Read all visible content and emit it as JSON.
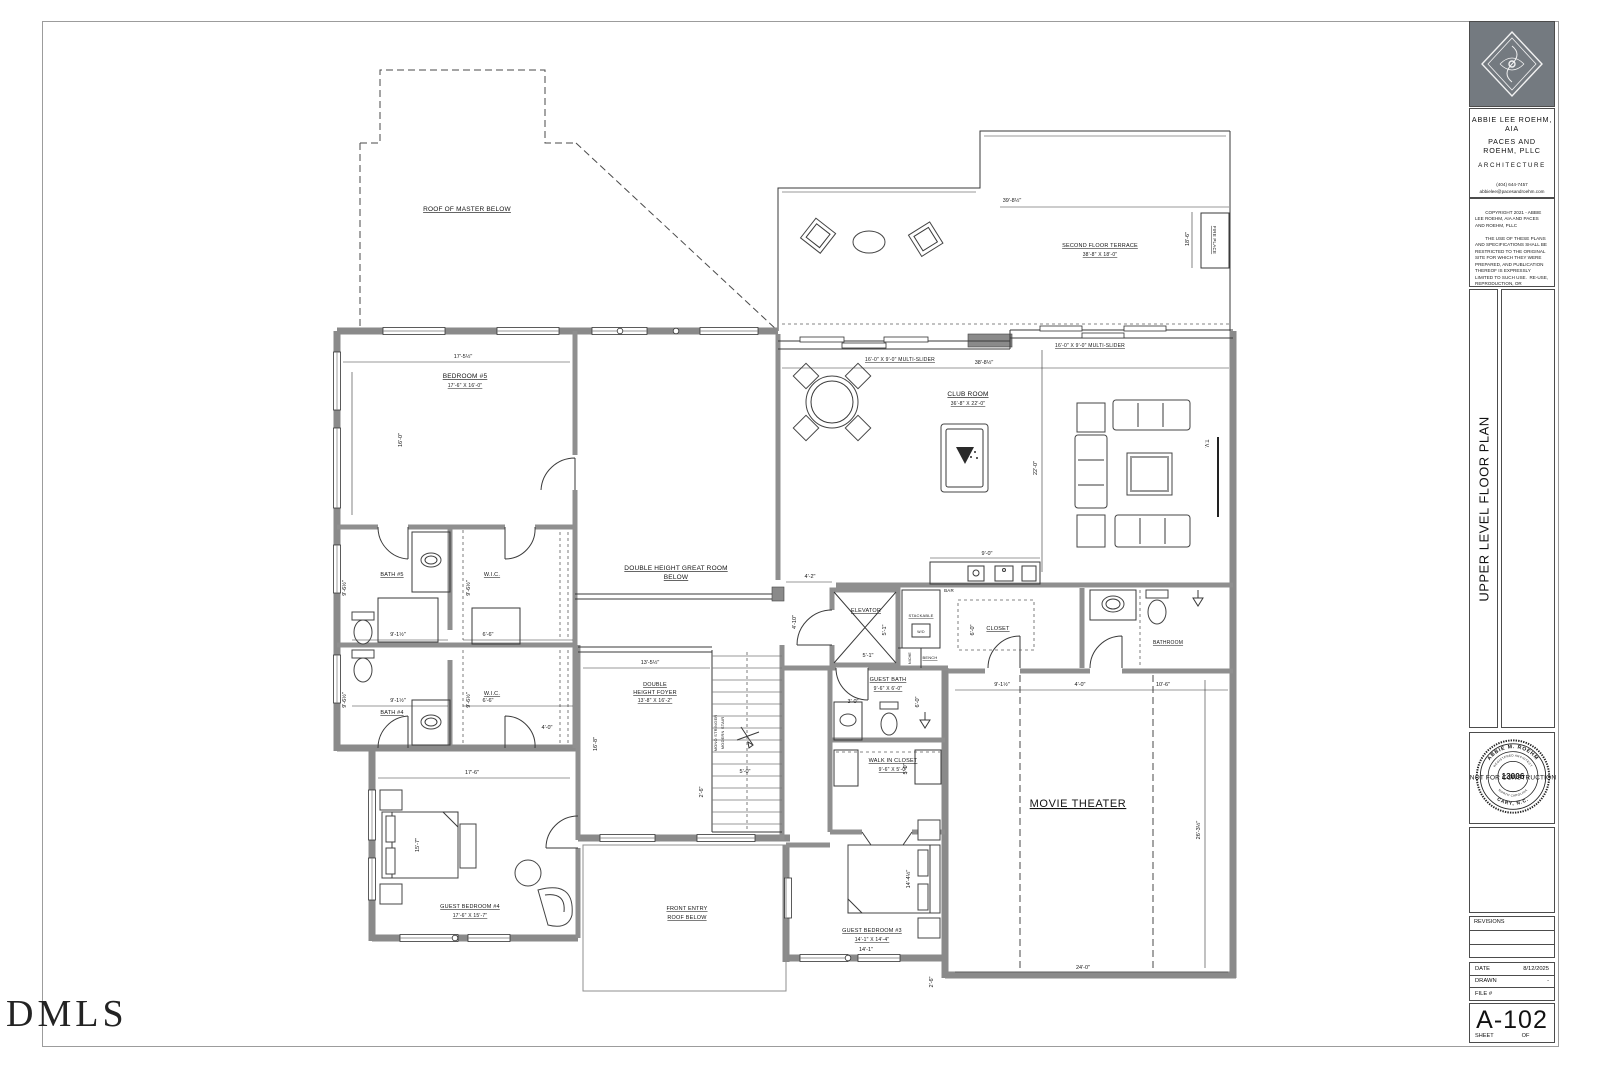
{
  "watermark": "DMLS",
  "tb": {
    "firm1": "ABBIE LEE ROEHM, AIA",
    "firm2": "PACES AND ROEHM, PLLC",
    "firm3": "ARCHITECTURE",
    "phone": "(404) 644-7457",
    "email": "abbielee@pacesandroehm.com",
    "copy1": "COPYRIGHT 2021 - ABBIE LEE ROEHM, AIA AND PACES AND ROEHM, PLLC",
    "copy2": "THE USE OF THESE PLANS AND SPECIFICATIONS SHALL BE RESTRICTED TO THE ORIGINAL SITE FOR WHICH THEY WERE PREPARED, AND PUBLICATION THEREOF IS EXPRESSLY LIMITED TO SUCH USE.  RE-USE, REPRODUCTION, OR PUBLICATION BY ANY METHOD, IN WHOLE OR IN PART, IS PROHIBITED.  TITLE TO THE DESIGNS, PLANS AND SPECIFICATIONS REMAIN IN THE ARCHITECT WITHOUT PREJUDICE.  VISUAL CONTACT WITH THESE PLANS AND SPECIFICATIONS SHALL CONSTITUTE PRIMA FACIE EVIDENCE OF THE ACCEPTANCE OF THESE RESTRICTIONS.",
    "sheet_title": "UPPER LEVEL FLOOR PLAN",
    "stamp_name": "ABBIE M. ROEHM",
    "stamp_reg": "REGISTERED ARCHITECT",
    "stamp_no": "13006",
    "stamp_state": "NORTH CAROLINA",
    "stamp_city": "CARY, N.C.",
    "stamp_overlay": "NOT FOR CONSTRUCTION",
    "revisions": "REVISIONS",
    "date_label": "DATE",
    "date_value": "8/12/2025",
    "drawn_label": "DRAWN",
    "drawn_value": "-",
    "file_label": "FILE #",
    "sheet_no": "A-102",
    "sheet_label": "SHEET",
    "of_label": "OF"
  },
  "plan": {
    "roof_master": "ROOF OF MASTER BELOW",
    "terrace_name": "SECOND FLOOR TERRACE",
    "terrace_dims": "38'-8\" X 18'-0\"",
    "fireplace": "FIRE PLACE",
    "bedroom5_name": "BEDROOM #5",
    "bedroom5_dims": "17'-6\" X 16'-0\"",
    "multislider_left": "16'-0\" X 9'-0\" MULTI-SLIDER",
    "multislider_right": "16'-0\" X 9'-0\" MULTI-SLIDER",
    "club_name": "CLUB ROOM",
    "club_dims": "36'-8\" X 22'-0\"",
    "tv": "T.V.",
    "great1": "DOUBLE HEIGHT GREAT ROOM",
    "great2": "BELOW",
    "bath5": "BATH #5",
    "wic_top": "W.I.C.",
    "bath4": "BATH #4",
    "wic_bottom": "W.I.C.",
    "foyer1": "DOUBLE",
    "foyer2": "HEIGHT FOYER",
    "foyer3": "13'-8\" X 16'-2\"",
    "stair1": "MONO STRINGER",
    "stair2": "MODERN STAIR",
    "elevator": "ELEVATOR",
    "stackable": "STACKABLE",
    "wd": "W/D",
    "niche": "NICHE",
    "bench": "BENCH",
    "bar": "BAR",
    "closet": "CLOSET",
    "bathroom": "BATHROOM",
    "gbath1": "GUEST BATH",
    "gbath2": "9'-6\" X 6'-0\"",
    "wic_name": "WALK IN CLOSET",
    "wic_dims": "9'-6\" X 5'-0\"",
    "movie": "MOVIE THEATER",
    "gb3_name": "GUEST BEDROOM #3",
    "gb3_dims": "14'-1\" X 14'-4\"",
    "gb4_name": "GUEST BEDROOM #4",
    "gb4_dims": "17'-6\" X 15'-7\"",
    "fe1": "FRONT ENTRY",
    "fe2": "ROOF BELOW"
  },
  "dims": {
    "terrace_top": "39'-8½\"",
    "terrace_right": "18'-6\"",
    "bedroom5_top": "17'-5½\"",
    "bedroom5_left": "16'-0\"",
    "club_top": "38'-8½\"",
    "club_left": "22'-0\"",
    "bar_top": "9'-0\"",
    "gap_h": "4'-2\"",
    "gap_v": "4'-10\"",
    "foyer_top": "13'-5½\"",
    "foyer_left": "16'-8\"",
    "stair_w": "5'-0\"",
    "stair_s": "2'-6\"",
    "bath5_left": "9'-6½\"",
    "bath5_in": "9'-1½\"",
    "bath4_left": "9'-6½\"",
    "bath4_in": "9'-1½\"",
    "wic1_w": "6'-6\"",
    "wic1_v": "9'-6½\"",
    "wic2_w": "6'-6\"",
    "wic2_v": "9'-6½\"",
    "hall4": "4'-0\"",
    "gb4_top": "17'-6\"",
    "gb4_left": "15'-7\"",
    "elev_w": "5'-1\"",
    "elev_h": "5'-1\"",
    "gbath_door": "3'-0\"",
    "gbath_v": "6'-0\"",
    "closet_v": "6'-0\"",
    "closet_w": "9'-1½\"",
    "bath_hall": "4'-0\"",
    "bath_w": "10'-6\"",
    "wic3_v": "5'-0\"",
    "gb3_v": "14'-4½\"",
    "gb3_b": "14'-1\"",
    "mt_b": "24'-0\"",
    "mt_r": "26'-3½\"",
    "mt_step": "2'-6\""
  }
}
